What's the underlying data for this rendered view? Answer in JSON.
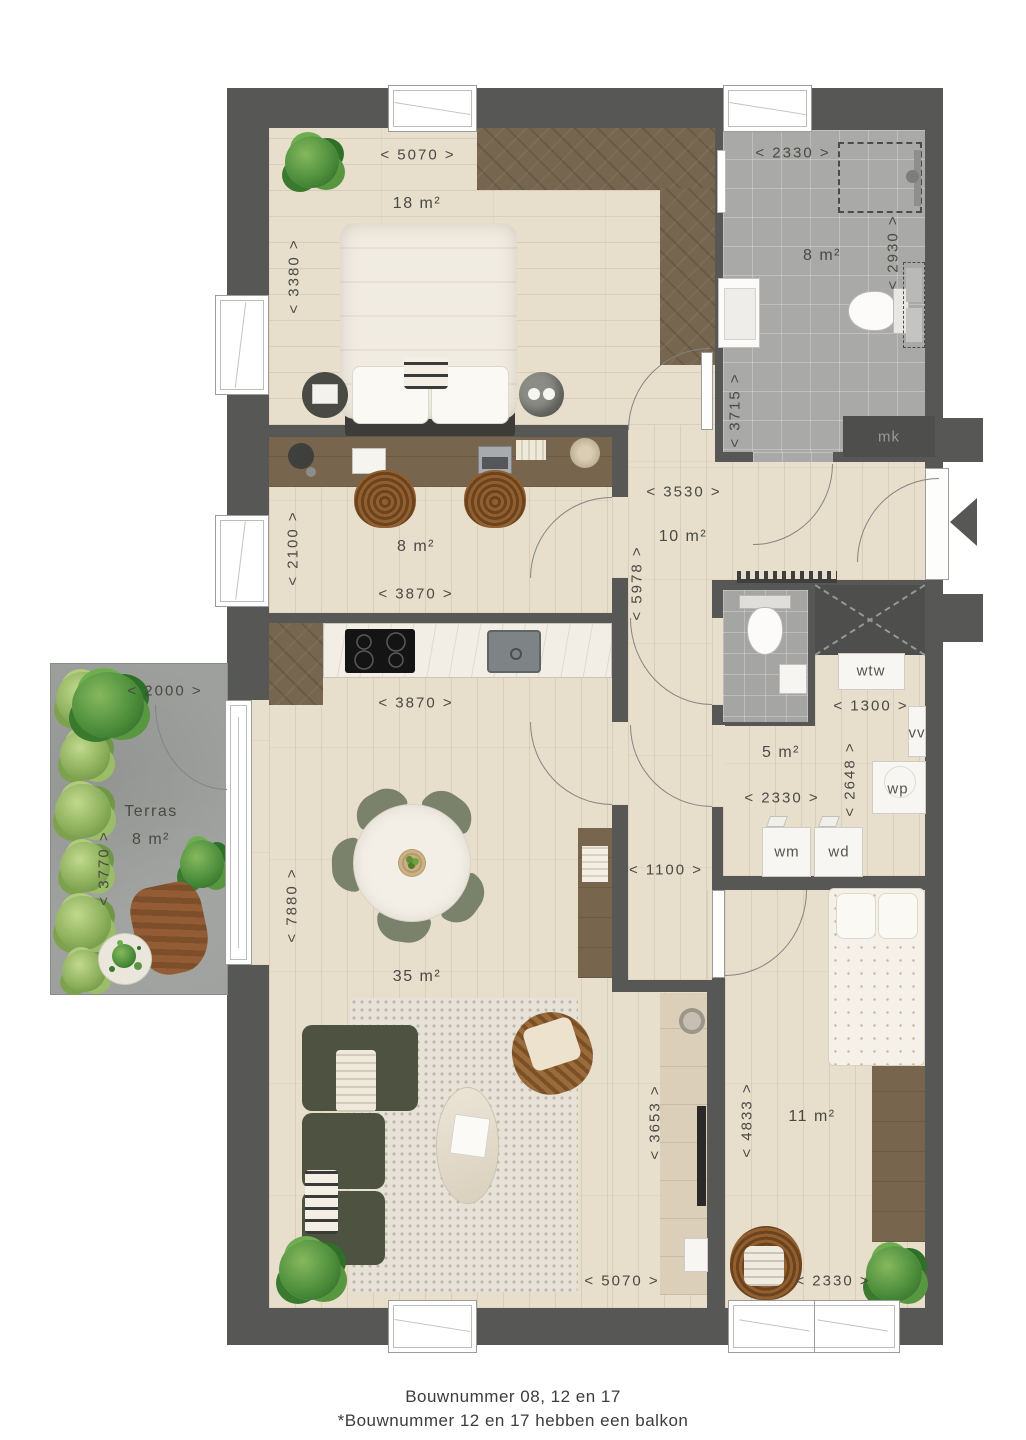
{
  "rooms": {
    "bedroom1": {
      "area": "18 m²"
    },
    "bathroom": {
      "area": "8 m²"
    },
    "study": {
      "area": "8 m²"
    },
    "hall": {
      "area": "10 m²"
    },
    "technical": {
      "area": "5 m²"
    },
    "living": {
      "area": "35 m²"
    },
    "bedroom2": {
      "area": "11 m²"
    },
    "terrace": {
      "name": "Terras",
      "area": "8 m²"
    }
  },
  "dims": {
    "top_5070": "< 5070 >",
    "bed1_3380": "< 3380 >",
    "bath_2330": "< 2330 >",
    "bath_2930": "< 2930 >",
    "bath_3715": "< 3715 >",
    "hall_3530": "< 3530 >",
    "hall_5978": "< 5978 >",
    "study_2100": "< 2100 >",
    "study_3870": "< 3870 >",
    "kitchen_3870": "< 3870 >",
    "living_7880": "< 7880 >",
    "corridor_1100": "< 1100 >",
    "tech_1300": "< 1300 >",
    "tech_2648": "< 2648 >",
    "tech_2330": "< 2330 >",
    "terrace_2000": "< 2000 >",
    "terrace_3770": "< 3770 >",
    "living_3653": "< 3653 >",
    "living_5070": "< 5070 >",
    "bed2_4833": "< 4833 >",
    "bed2_2330": "< 2330 >"
  },
  "fixtures": {
    "mk": "mk",
    "wtw": "wtw",
    "vv": "vv",
    "wp": "wp",
    "wm": "wm",
    "wd": "wd"
  },
  "caption": {
    "line1": "Bouwnummer 08, 12 en 17",
    "line2": "*Bouwnummer 12 en 17 hebben een balkon"
  },
  "colors": {
    "wall": "#575756",
    "wood_floor": "#e8decc",
    "dark_wood": "#76654f",
    "tile": "#a9a9a8",
    "terrace_concrete": "#9ea09d",
    "plant_green": "#4e8f3c",
    "sofa_green": "#4d5340"
  }
}
